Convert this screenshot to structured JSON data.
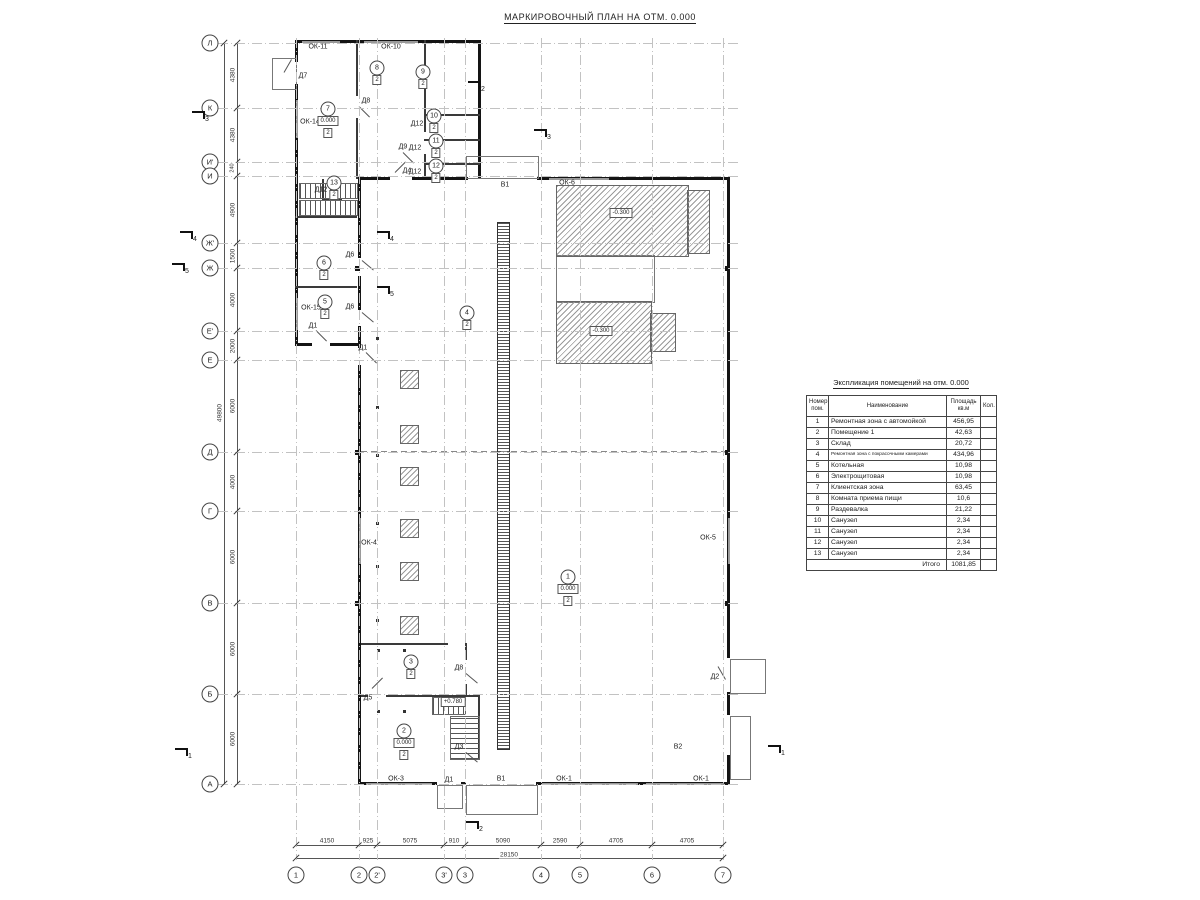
{
  "title": "МАРКИРОВОЧНЫЙ ПЛАН НА ОТМ. 0.000",
  "axes": {
    "left": [
      {
        "label": "Л",
        "y": 43
      },
      {
        "label": "К",
        "y": 108
      },
      {
        "label": "И'",
        "y": 162
      },
      {
        "label": "И",
        "y": 176
      },
      {
        "label": "Ж'",
        "y": 243
      },
      {
        "label": "Ж",
        "y": 268
      },
      {
        "label": "Е'",
        "y": 331
      },
      {
        "label": "Е",
        "y": 360
      },
      {
        "label": "Д",
        "y": 452
      },
      {
        "label": "Г",
        "y": 511
      },
      {
        "label": "В",
        "y": 603
      },
      {
        "label": "Б",
        "y": 694
      },
      {
        "label": "А",
        "y": 784
      }
    ],
    "bottom": [
      {
        "label": "1",
        "x": 296
      },
      {
        "label": "2",
        "x": 359
      },
      {
        "label": "2'",
        "x": 377
      },
      {
        "label": "3'",
        "x": 444
      },
      {
        "label": "3",
        "x": 465
      },
      {
        "label": "4",
        "x": 541
      },
      {
        "label": "5",
        "x": 580
      },
      {
        "label": "6",
        "x": 652
      },
      {
        "label": "7",
        "x": 723
      }
    ]
  },
  "dims": {
    "left": [
      {
        "v": "4380",
        "y": 75
      },
      {
        "v": "4380",
        "y": 135
      },
      {
        "v": "240",
        "y": 168,
        "small": true
      },
      {
        "v": "4900",
        "y": 210
      },
      {
        "v": "1500",
        "y": 256
      },
      {
        "v": "4000",
        "y": 300
      },
      {
        "v": "2000",
        "y": 346
      },
      {
        "v": "6000",
        "y": 406
      },
      {
        "v": "4000",
        "y": 482
      },
      {
        "v": "6000",
        "y": 557
      },
      {
        "v": "6000",
        "y": 649
      },
      {
        "v": "6000",
        "y": 739
      }
    ],
    "left_total": {
      "v": "49800",
      "y": 413
    },
    "bottom": [
      {
        "v": "4150",
        "x": 327
      },
      {
        "v": "925",
        "x": 368
      },
      {
        "v": "5075",
        "x": 410
      },
      {
        "v": "910",
        "x": 454
      },
      {
        "v": "5090",
        "x": 503
      },
      {
        "v": "2590",
        "x": 560
      },
      {
        "v": "4705",
        "x": 616
      },
      {
        "v": "4705",
        "x": 687
      }
    ],
    "bottom_total": {
      "v": "28150",
      "x": 509
    }
  },
  "labels": [
    {
      "t": "ОК-11",
      "x": 318,
      "y": 47
    },
    {
      "t": "ОК-10",
      "x": 391,
      "y": 47
    },
    {
      "t": "Д7",
      "x": 303,
      "y": 76
    },
    {
      "t": "Д8",
      "x": 366,
      "y": 101
    },
    {
      "t": "Д9",
      "x": 403,
      "y": 147
    },
    {
      "t": "Д4",
      "x": 407,
      "y": 171
    },
    {
      "t": "ОК-14",
      "x": 310,
      "y": 122
    },
    {
      "t": "Д12",
      "x": 321,
      "y": 190
    },
    {
      "t": "Д12",
      "x": 417,
      "y": 124
    },
    {
      "t": "Д12",
      "x": 415,
      "y": 148
    },
    {
      "t": "Д12",
      "x": 415,
      "y": 172
    },
    {
      "t": "ОК-15",
      "x": 311,
      "y": 308
    },
    {
      "t": "Д6",
      "x": 350,
      "y": 255
    },
    {
      "t": "Д6",
      "x": 350,
      "y": 307
    },
    {
      "t": "Д1",
      "x": 313,
      "y": 326
    },
    {
      "t": "Д1",
      "x": 363,
      "y": 348
    },
    {
      "t": "ОК-6",
      "x": 567,
      "y": 183
    },
    {
      "t": "В1",
      "x": 505,
      "y": 185
    },
    {
      "t": "ОК-4",
      "x": 369,
      "y": 543
    },
    {
      "t": "ОК-5",
      "x": 708,
      "y": 538
    },
    {
      "t": "Д5",
      "x": 368,
      "y": 698
    },
    {
      "t": "Д8",
      "x": 459,
      "y": 668
    },
    {
      "t": "Д3",
      "x": 459,
      "y": 747
    },
    {
      "t": "Д2",
      "x": 715,
      "y": 677
    },
    {
      "t": "В2",
      "x": 678,
      "y": 747
    },
    {
      "t": "ОК-3",
      "x": 396,
      "y": 779
    },
    {
      "t": "Д1",
      "x": 449,
      "y": 780
    },
    {
      "t": "В1",
      "x": 501,
      "y": 779
    },
    {
      "t": "ОК-1",
      "x": 564,
      "y": 779
    },
    {
      "t": "ОК-1",
      "x": 701,
      "y": 779
    }
  ],
  "elevations": [
    {
      "v": "-0.300",
      "x": 621,
      "y": 213
    },
    {
      "v": "-0.300",
      "x": 601,
      "y": 331
    },
    {
      "v": "+0.780",
      "x": 453,
      "y": 702
    }
  ],
  "rooms": [
    {
      "num": "7",
      "x": 328,
      "y": 109,
      "elev": "0.000",
      "finish": "2"
    },
    {
      "num": "8",
      "x": 377,
      "y": 68,
      "finish": "2"
    },
    {
      "num": "9",
      "x": 423,
      "y": 72,
      "finish": "2"
    },
    {
      "num": "10",
      "x": 434,
      "y": 116,
      "finish": "2"
    },
    {
      "num": "11",
      "x": 436,
      "y": 141,
      "finish": "2"
    },
    {
      "num": "12",
      "x": 436,
      "y": 166,
      "finish": "2"
    },
    {
      "num": "13",
      "x": 334,
      "y": 183,
      "finish": "2"
    },
    {
      "num": "6",
      "x": 324,
      "y": 263,
      "finish": "2"
    },
    {
      "num": "5",
      "x": 325,
      "y": 302,
      "finish": "2"
    },
    {
      "num": "4",
      "x": 467,
      "y": 313,
      "finish": "2"
    },
    {
      "num": "1",
      "x": 568,
      "y": 577,
      "elev": "0.000",
      "finish": "2"
    },
    {
      "num": "2",
      "x": 404,
      "y": 731,
      "elev": "0.000",
      "finish": "2"
    },
    {
      "num": "3",
      "x": 411,
      "y": 662,
      "finish": "2"
    }
  ],
  "sections": [
    {
      "n": "3",
      "x": 203,
      "y": 118
    },
    {
      "n": "2",
      "x": 479,
      "y": 88
    },
    {
      "n": "3",
      "x": 545,
      "y": 136
    },
    {
      "n": "4",
      "x": 191,
      "y": 238
    },
    {
      "n": "4",
      "x": 388,
      "y": 238
    },
    {
      "n": "5",
      "x": 183,
      "y": 270
    },
    {
      "n": "5",
      "x": 388,
      "y": 293
    },
    {
      "n": "1",
      "x": 186,
      "y": 755
    },
    {
      "n": "1",
      "x": 779,
      "y": 752
    },
    {
      "n": "2",
      "x": 477,
      "y": 828
    }
  ],
  "schedule": {
    "title": "Экспликация помещений на отм. 0.000",
    "columns": [
      "Номер.\nпом.",
      "Наименование",
      "Площадь\nкв.м",
      "Кол."
    ],
    "rows": [
      [
        "1",
        "Ремонтная зона с автомойкой",
        "456,95",
        ""
      ],
      [
        "2",
        "Помещение 1",
        "42,63",
        ""
      ],
      [
        "3",
        "Склад",
        "20,72",
        ""
      ],
      [
        "4",
        "Ремонтная зона с покрасочными камерами",
        "434,96",
        ""
      ],
      [
        "5",
        "Котельная",
        "10,98",
        ""
      ],
      [
        "6",
        "Электрощитовая",
        "10,98",
        ""
      ],
      [
        "7",
        "Клиентская зона",
        "63,45",
        ""
      ],
      [
        "8",
        "Комната приема пищи",
        "10,6",
        ""
      ],
      [
        "9",
        "Раздевалка",
        "21,22",
        ""
      ],
      [
        "10",
        "Санузел",
        "2,34",
        ""
      ],
      [
        "11",
        "Санузел",
        "2,34",
        ""
      ],
      [
        "12",
        "Санузел",
        "2,34",
        ""
      ],
      [
        "13",
        "Санузел",
        "2,34",
        ""
      ]
    ],
    "total_label": "Итого",
    "total_value": "1081,85"
  }
}
